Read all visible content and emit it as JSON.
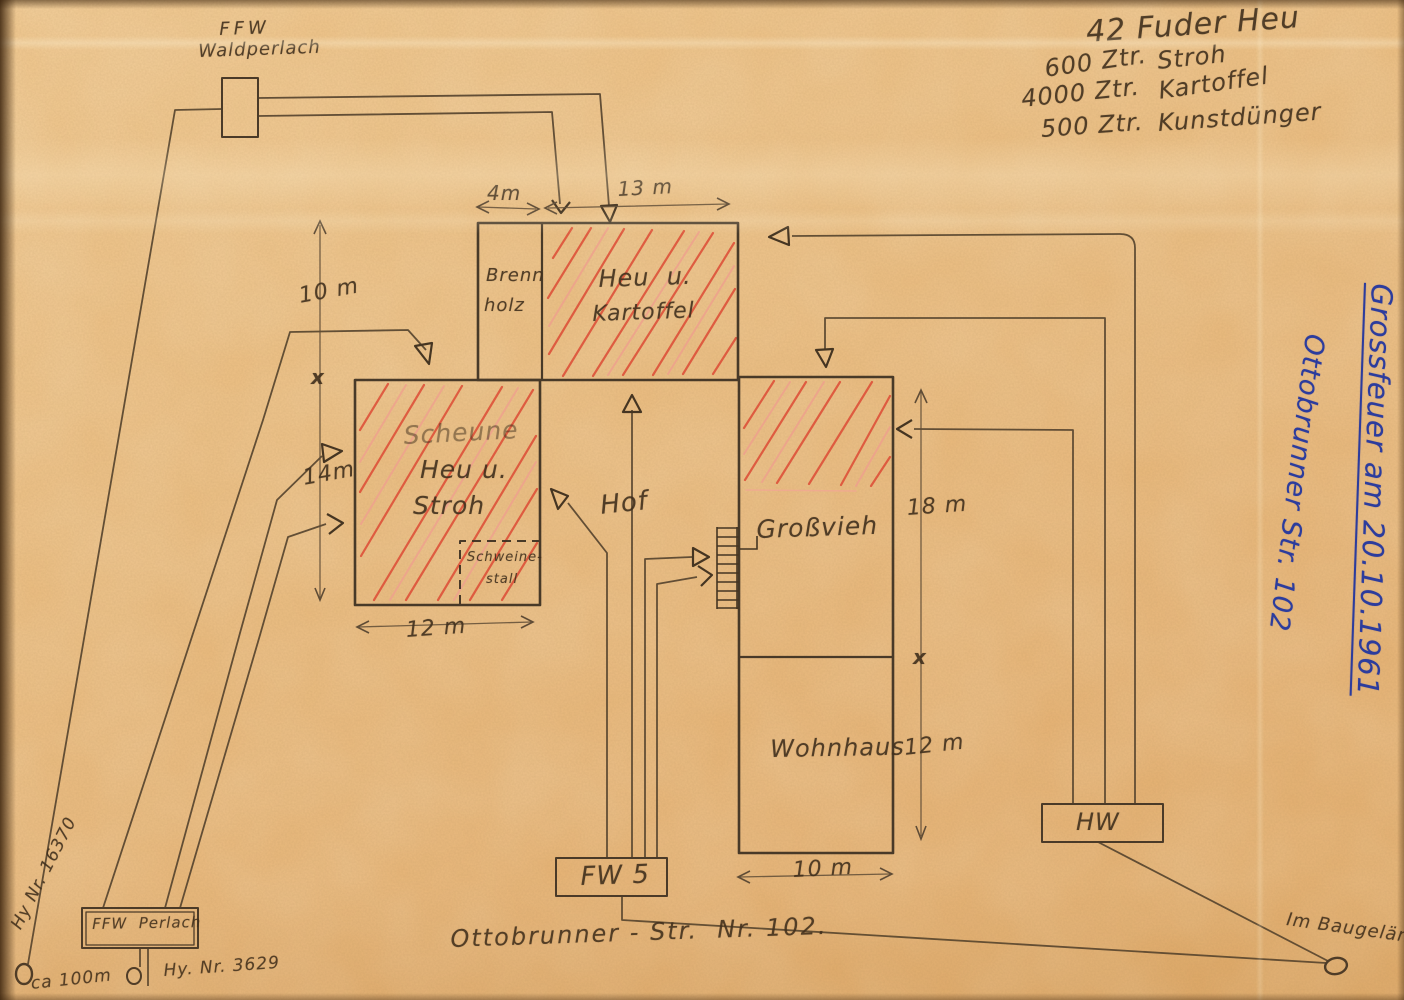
{
  "document": {
    "kind": "hand-drawn fire operation site plan, scanned",
    "paper_color": "#ecbd80"
  },
  "title_vertical": {
    "line1": "Grossfeuer am 20.10.1961",
    "line2": "Ottobrunner Str. 102",
    "ink_color": "#2c3c9d"
  },
  "notes": {
    "header": "42 Fuder Heu",
    "rows": [
      {
        "qty": "600 Ztr.",
        "item": "Stroh"
      },
      {
        "qty": "4000 Ztr.",
        "item": "Kartoffel"
      },
      {
        "qty": "500 Ztr.",
        "item": "Kunstdünger"
      }
    ]
  },
  "stations": {
    "waldperlach_line1": "FFW",
    "waldperlach_line2": "Waldperlach",
    "perlach": "FFW  Perlach",
    "fw5": "FW 5",
    "hw": "HW"
  },
  "buildings": {
    "brennholz_line1": "Brenn",
    "brennholz_line2": "holz",
    "heukartoffel_line1": "Heu  u.",
    "heukartoffel_line2": "Kartoffel",
    "scheune_line1": "Scheune",
    "scheune_line2": "Heu u.",
    "scheune_line3": "Stroh",
    "schweinestall_line1": "Schweine-",
    "schweinestall_line2": "stall",
    "grossvieh": "Großvieh",
    "wohnhaus": "Wohnhaus",
    "hof": "Hof"
  },
  "measurements": {
    "top_left": "4m",
    "top_right": "13 m",
    "left_upper": "10 m",
    "left_x": "x",
    "left_lower": "14m",
    "scheune_width": "12 m",
    "right_upper": "18 m",
    "right_x": "x",
    "right_lower": "12 m",
    "wohnhaus_width": "10 m"
  },
  "water": {
    "hydrant_left_line": "Hy Nr. 16370",
    "hydrant_left_distance": "ca 100m",
    "hydrant_perlach": "Hy. Nr. 3629",
    "hydrant_site": "Im Baugelän."
  },
  "street": "Ottobrunner - Str.  Nr. 102.",
  "colors": {
    "pencil": "#4a3a28",
    "red_hatch": "#dc4430",
    "blue_ink": "#2c3c9d"
  }
}
